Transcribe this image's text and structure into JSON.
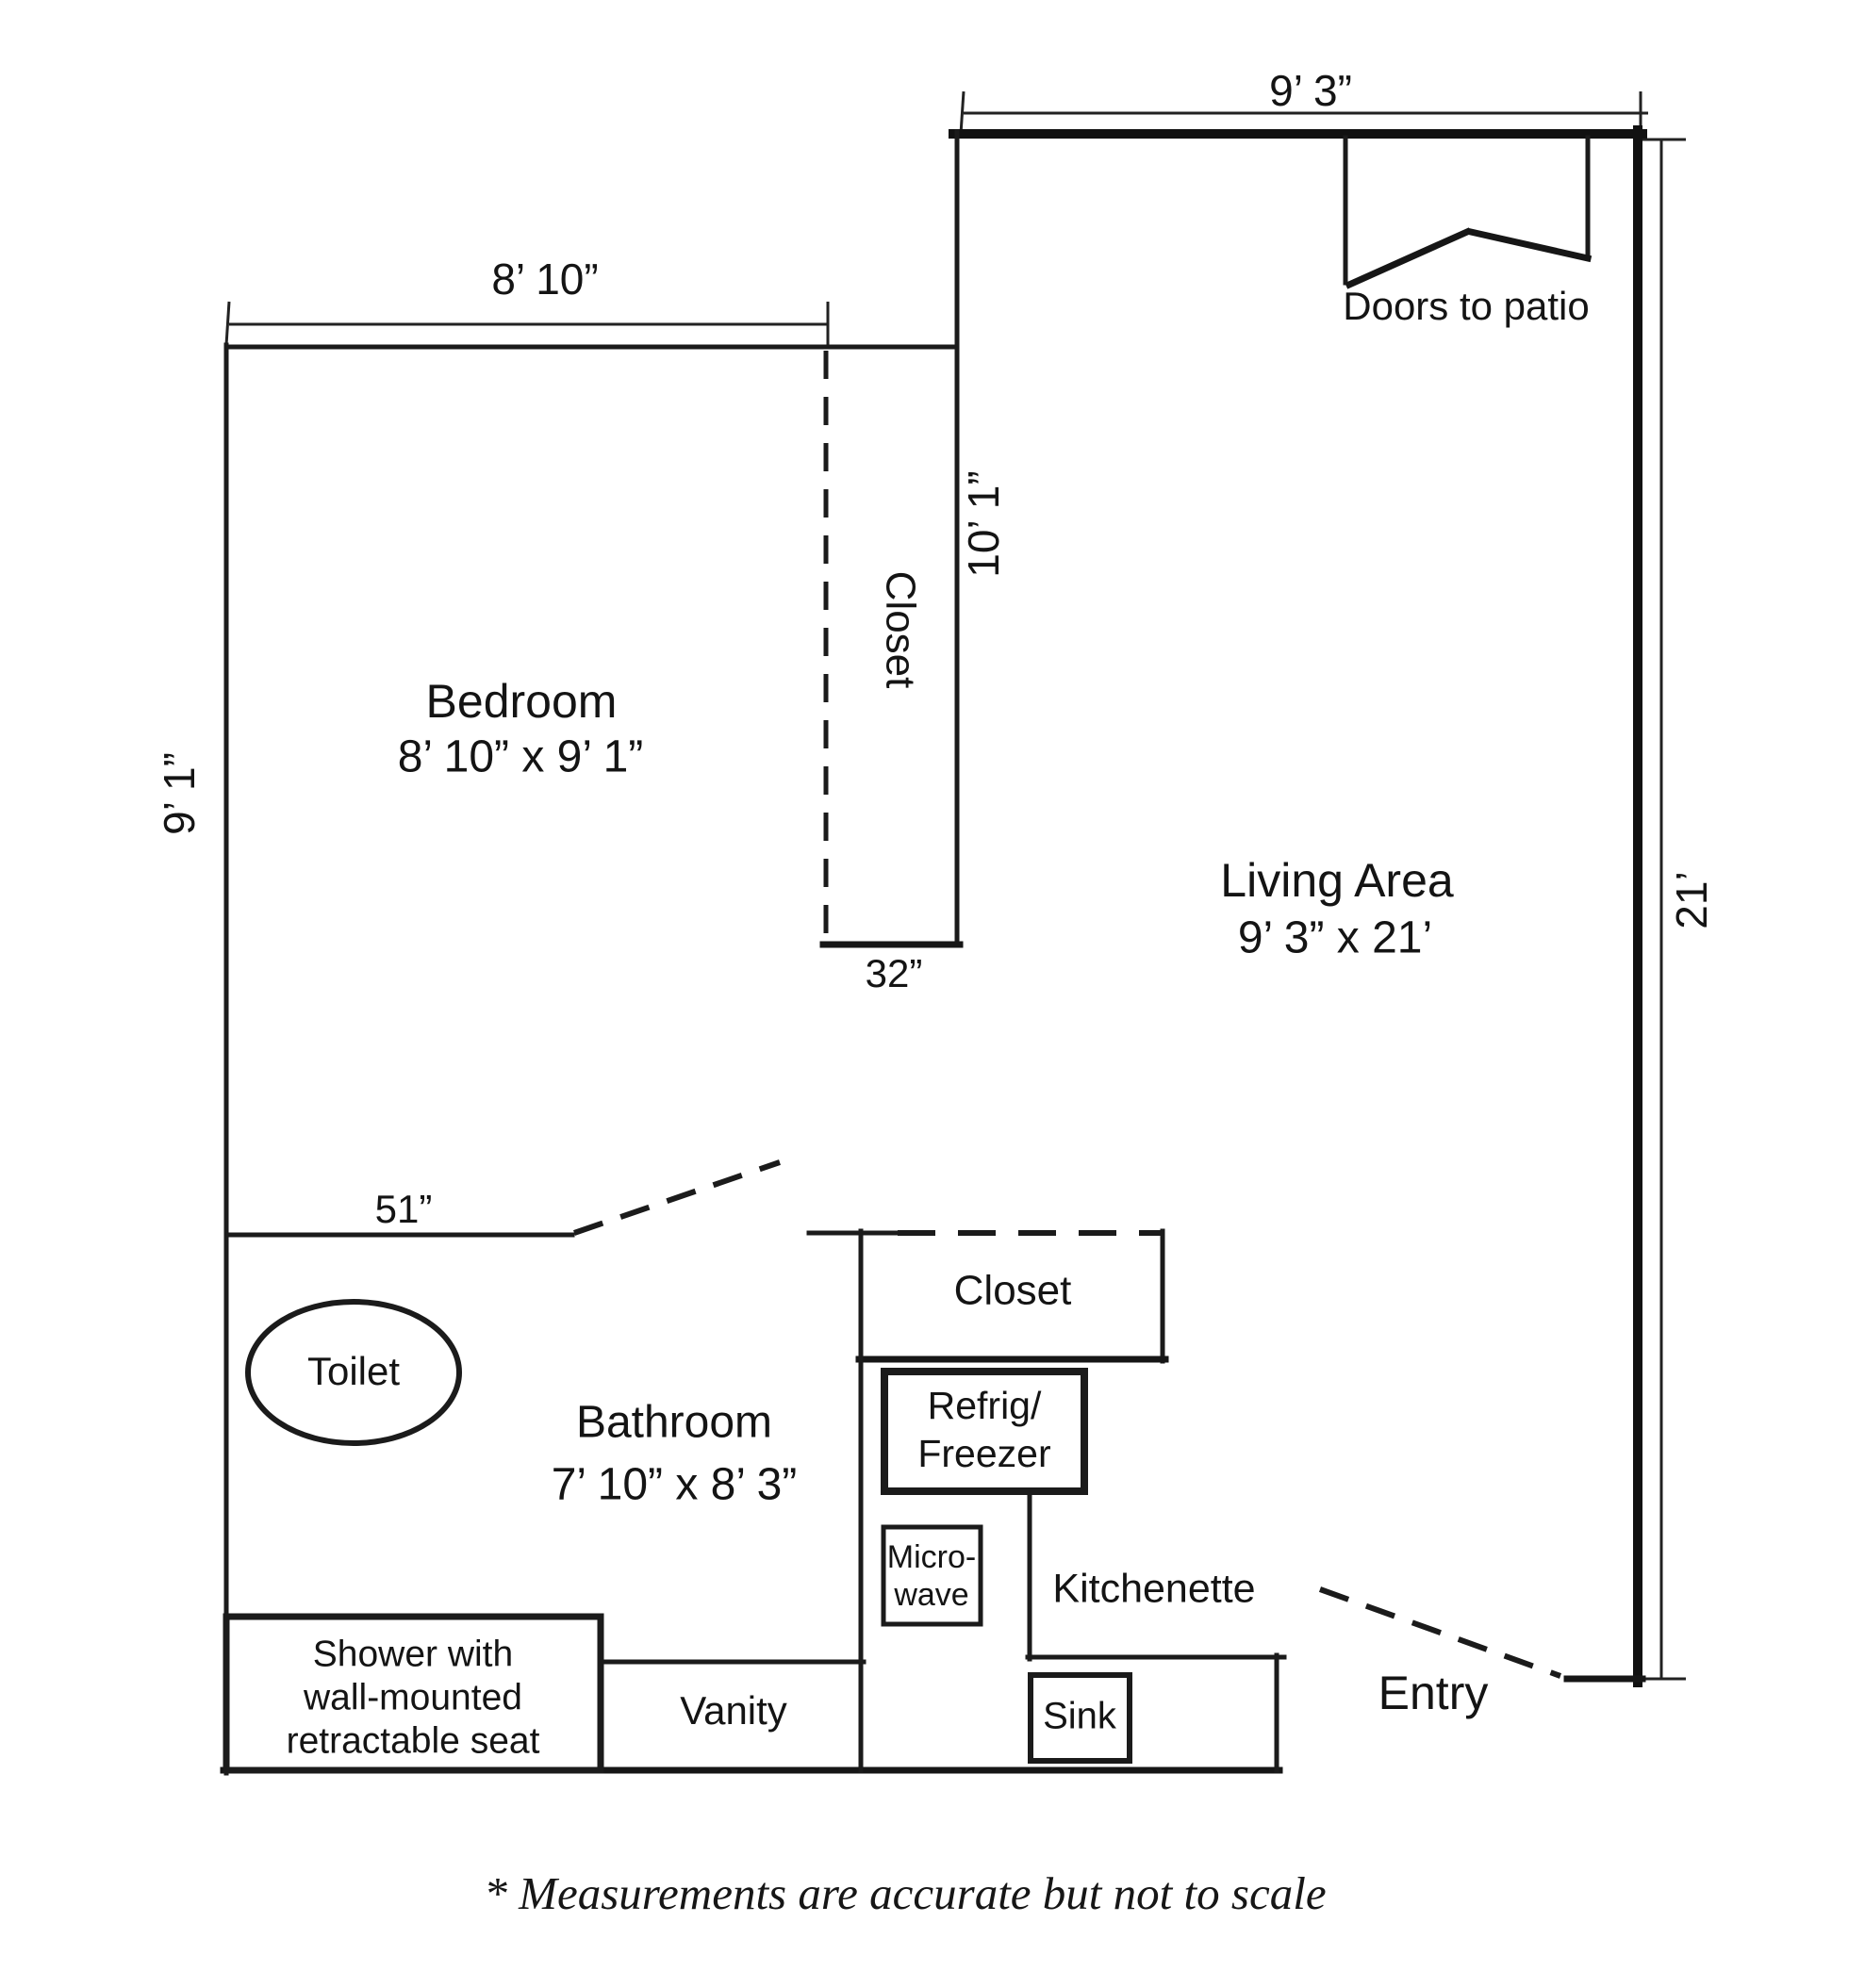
{
  "colors": {
    "ink": "#1b1b1b",
    "paper": "#ffffff"
  },
  "rooms": {
    "bedroom": {
      "name": "Bedroom",
      "size": "8’ 10” x 9’ 1”"
    },
    "living": {
      "name": "Living Area",
      "size": "9’ 3” x 21’"
    },
    "bathroom": {
      "name": "Bathroom",
      "size": "7’ 10” x 8’ 3”"
    },
    "kitchenette": {
      "name": "Kitchenette"
    },
    "entry": {
      "name": "Entry"
    }
  },
  "closets": {
    "bedroom_closet": "Closet",
    "kitchen_closet": "Closet"
  },
  "doors": {
    "patio": "Doors to patio"
  },
  "fixtures": {
    "toilet": "Toilet",
    "shower": {
      "line1": "Shower with",
      "line2": "wall-mounted",
      "line3": "retractable seat"
    },
    "vanity": "Vanity",
    "sink": "Sink",
    "refrigerator": {
      "line1": "Refrig/",
      "line2": "Freezer"
    },
    "microwave": {
      "line1": "Micro-",
      "line2": "wave"
    }
  },
  "dimensions": {
    "living_width": "9’ 3”",
    "living_depth": "21’",
    "bedroom_width": "8’ 10”",
    "bedroom_depth": "9’ 1”",
    "living_wall": "10’ 1”",
    "bathroom_wall": "51”",
    "closet_opening": "32”"
  },
  "footnote": "* Measurements are accurate but not to scale"
}
